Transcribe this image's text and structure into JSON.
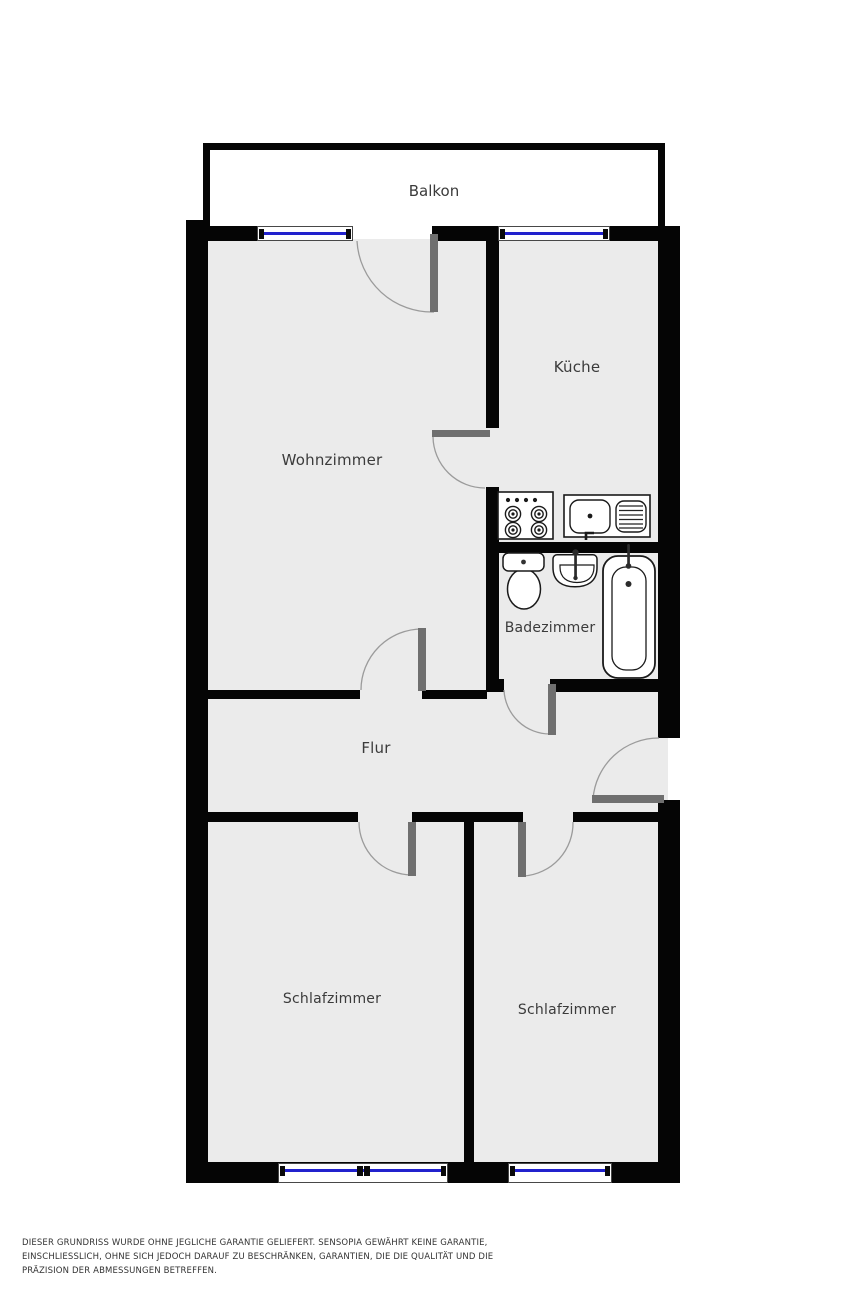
{
  "plan": {
    "rooms": {
      "balkon": "Balkon",
      "wohnzimmer": "Wohnzimmer",
      "kueche": "Küche",
      "badezimmer": "Badezimmer",
      "flur": "Flur",
      "schlafzimmer_links": "Schlafzimmer",
      "schlafzimmer_rechts": "Schlafzimmer"
    },
    "fixtures": [
      "stove-icon",
      "kitchen-sink-icon",
      "toilet-icon",
      "washbasin-icon",
      "bathtub-icon"
    ],
    "colors": {
      "wall": "#050505",
      "floor": "#ebebeb",
      "balcony_floor": "#ffffff",
      "window_glass": "#2121cd",
      "door_leaf": "#6f6f6f",
      "door_arc": "#9b9b9b",
      "label_text": "#3b3b3b"
    }
  },
  "disclaimer": {
    "lines": [
      "DIESER GRUNDRISS WURDE OHNE JEGLICHE GARANTIE GELIEFERT. SENSOPIA GEWÄHRT KEINE GARANTIE,",
      "EINSCHLIESSLICH, OHNE SICH JEDOCH DARAUF ZU BESCHRÄNKEN, GARANTIEN, DIE DIE QUALITÄT UND DIE",
      "PRÄZISION DER ABMESSUNGEN BETREFFEN."
    ]
  }
}
